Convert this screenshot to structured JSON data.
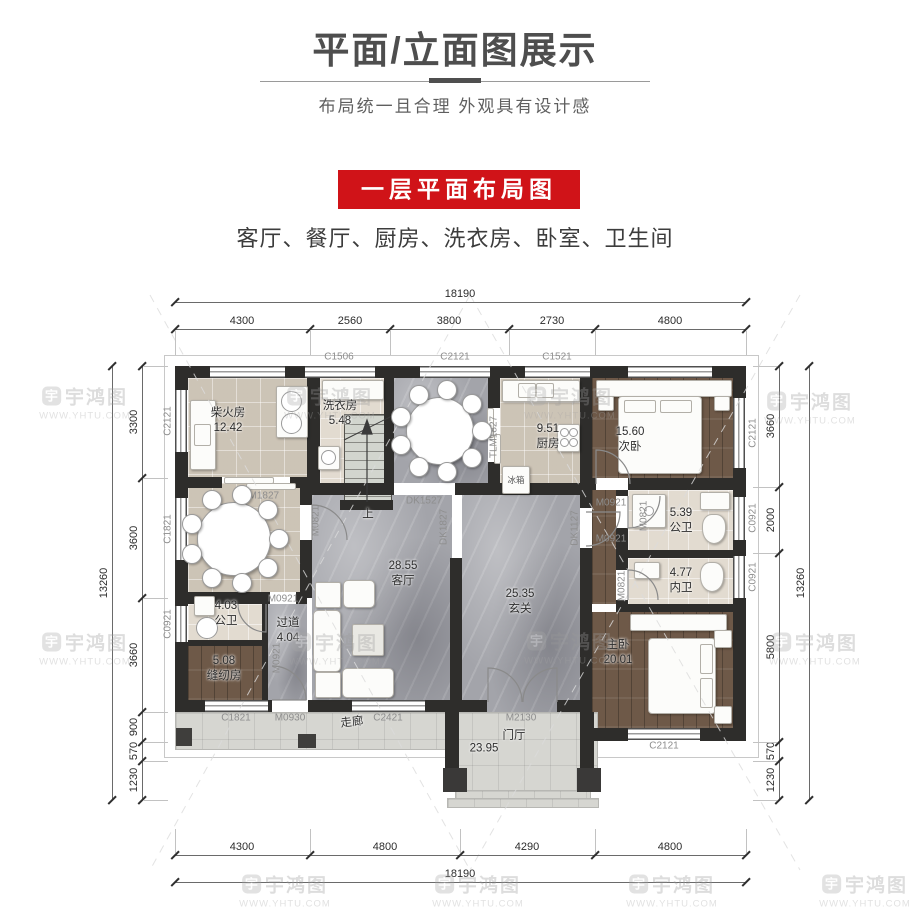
{
  "header": {
    "title": "平面/立面图展示",
    "subtitle": "布局统一且合理  外观具有设计感",
    "banner": "一层平面布局图",
    "room_list": "客厅、餐厅、厨房、洗衣房、卧室、卫生间"
  },
  "watermark": {
    "logo": "宇",
    "brand": "宇鸿图",
    "site": "WWW.YHTU.COM"
  },
  "colors": {
    "banner_red": "#d01318",
    "wall": "#2e2d2b",
    "marble": "#a3a4aa",
    "wood": "#6e5948",
    "tile": "#d8d0c3"
  },
  "dimensions": {
    "top": {
      "total": "18190",
      "segments": [
        "4300",
        "2560",
        "3800",
        "2730",
        "4800"
      ]
    },
    "bottom": {
      "total": "18190",
      "segments": [
        "4300",
        "4800",
        "4290",
        "4800"
      ]
    },
    "left": {
      "total": "13260",
      "segments": [
        "3300",
        "3600",
        "3660",
        "900",
        "570",
        "1230"
      ]
    },
    "right": {
      "total": "13260",
      "segments": [
        "3660",
        "2000",
        "5800",
        "570",
        "1230"
      ]
    }
  },
  "rooms": {
    "chaihuofang": {
      "name": "柴火房",
      "area": "12.42"
    },
    "xiyifang": {
      "name": "洗衣房",
      "area": "5.48"
    },
    "canting_n": {
      "name": "餐厅",
      "area": "13.60"
    },
    "chufang": {
      "name": "厨房",
      "area": "9.51"
    },
    "ciwo": {
      "name": "次卧",
      "area": "15.60"
    },
    "canting_w": {
      "name": "餐厅",
      "area": "13.64"
    },
    "gongwei_e": {
      "name": "公卫",
      "area": "5.39"
    },
    "neiwei": {
      "name": "内卫",
      "area": "4.77"
    },
    "gongwei_w": {
      "name": "公卫",
      "area": "4.03"
    },
    "fengrenfang": {
      "name": "缝纫房",
      "area": "5.08"
    },
    "guodao": {
      "name": "过道",
      "area": "4.04"
    },
    "keting": {
      "name": "客厅",
      "area": "28.55"
    },
    "xuanguan": {
      "name": "玄关",
      "area": "25.35"
    },
    "zhuwo": {
      "name": "主卧",
      "area": "20.01"
    },
    "zoulang": {
      "name": "走廊"
    },
    "menting": {
      "name": "门厅",
      "area": "23.95"
    }
  },
  "labels": {
    "c1506": "C1506",
    "c2121": "C2121",
    "c1521": "C1521",
    "c1821": "C1821",
    "c0921": "C0921",
    "c2421": "C2421",
    "m2130": "M2130",
    "m0930": "M0930",
    "m0921": "M0921",
    "m0821": "M0821",
    "tlm1827": "TLM1827",
    "dk1527": "DK1527",
    "dk1827": "DK1827",
    "dk1127": "DK1127"
  },
  "misc": {
    "up": "上",
    "fridge": "冰箱"
  }
}
